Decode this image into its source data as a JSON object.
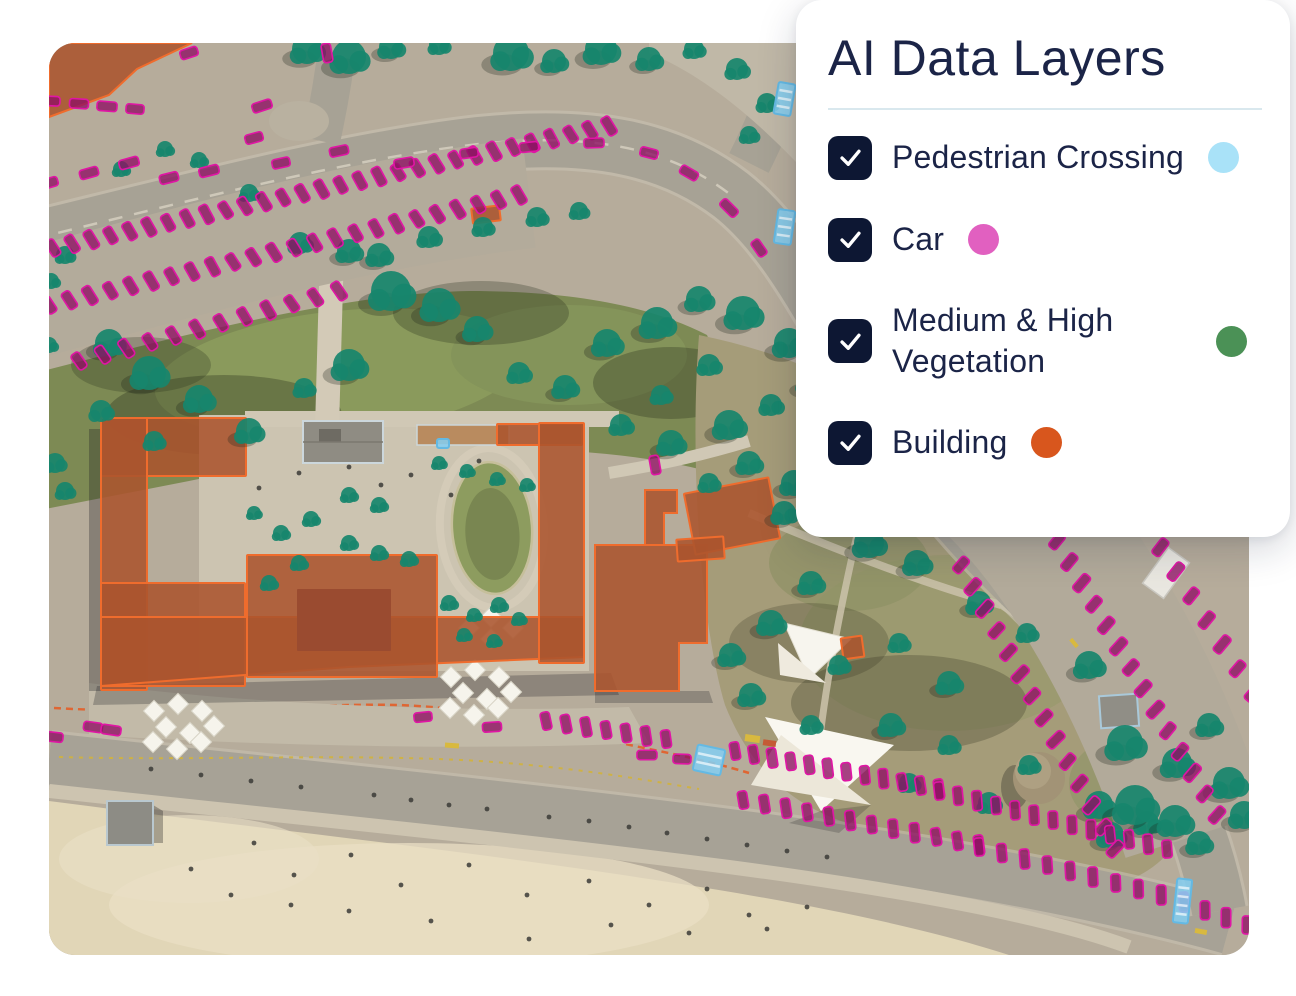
{
  "panel": {
    "title": "AI Data Layers",
    "layers": [
      {
        "id": "pedestrian-crossing",
        "label": "Pedestrian Crossing",
        "checked": true,
        "dot_color": "#a9e2f8"
      },
      {
        "id": "car",
        "label": "Car",
        "checked": true,
        "dot_color": "#e160c0"
      },
      {
        "id": "medium-high-vegetation",
        "label": "Medium & High Vegetation",
        "checked": true,
        "dot_color": "#4b9156"
      },
      {
        "id": "building",
        "label": "Building",
        "checked": true,
        "dot_color": "#d8561d"
      }
    ]
  },
  "map": {
    "overlay_colors": {
      "car_fill": "rgba(142,15,99,0.78)",
      "car_stroke": "#e015a5",
      "tree_fill": "rgba(23,134,108,0.92)",
      "tree_shadow": "rgba(30,36,24,0.28)",
      "building_fill": "rgba(171,84,46,0.88)",
      "building_stroke": "#ef6c2d",
      "crossing_fill": "rgba(133,205,239,0.88)",
      "crossing_stroke": "#64b9e3",
      "umbrella_fill": "#f6f4ec",
      "umbrella_stroke": "#d8d4c6",
      "people_fill": "#3b3b37"
    },
    "buildings": [
      {
        "d": "M0,0 L143,0 L88,26 L60,52 L0,74 Z"
      },
      {
        "x": 423,
        "y": 164,
        "w": 28,
        "h": 15,
        "rot": -7
      },
      {
        "x": 52,
        "y": 375,
        "w": 145,
        "h": 58
      },
      {
        "x": 52,
        "y": 375,
        "w": 46,
        "h": 272
      },
      {
        "x": 52,
        "y": 540,
        "w": 144,
        "h": 103
      },
      {
        "d": "M52,574 L535,574 L535,614 L300,624 L196,632 L52,643 Z"
      },
      {
        "x": 198,
        "y": 512,
        "w": 190,
        "h": 122
      },
      {
        "x": 248,
        "y": 546,
        "w": 94,
        "h": 62,
        "fill": "#9a4b30",
        "stroke": "none"
      },
      {
        "x": 448,
        "y": 381,
        "w": 85,
        "h": 21
      },
      {
        "x": 490,
        "y": 380,
        "w": 45,
        "h": 240
      },
      {
        "d": "M546,502 L658,502 L658,600 L630,600 L630,648 L546,648 Z"
      },
      {
        "x": 640,
        "y": 442,
        "w": 86,
        "h": 62,
        "rot": -11
      },
      {
        "d": "M596,447 L628,447 L628,470 L615,470 L615,502 L596,502 Z"
      },
      {
        "x": 628,
        "y": 495,
        "w": 47,
        "h": 22,
        "rot": -4
      },
      {
        "x": 793,
        "y": 594,
        "w": 21,
        "h": 21,
        "rot": -8
      }
    ],
    "trees": [
      [
        258,
        6,
        15
      ],
      [
        300,
        14,
        17
      ],
      [
        342,
        4,
        12
      ],
      [
        390,
        2,
        10
      ],
      [
        462,
        10,
        18
      ],
      [
        505,
        18,
        12
      ],
      [
        552,
        6,
        16
      ],
      [
        600,
        16,
        12
      ],
      [
        645,
        6,
        10
      ],
      [
        688,
        26,
        11
      ],
      [
        718,
        60,
        10
      ],
      [
        700,
        92,
        9
      ],
      [
        72,
        126,
        8
      ],
      [
        116,
        106,
        8
      ],
      [
        150,
        117,
        8
      ],
      [
        200,
        150,
        9
      ],
      [
        16,
        212,
        9
      ],
      [
        2,
        238,
        8
      ],
      [
        251,
        200,
        11
      ],
      [
        300,
        208,
        12
      ],
      [
        330,
        212,
        12
      ],
      [
        380,
        194,
        11
      ],
      [
        434,
        184,
        10
      ],
      [
        488,
        174,
        10
      ],
      [
        530,
        168,
        9
      ],
      [
        60,
        300,
        14
      ],
      [
        100,
        330,
        17
      ],
      [
        150,
        356,
        14
      ],
      [
        52,
        368,
        11
      ],
      [
        200,
        388,
        13
      ],
      [
        105,
        398,
        10
      ],
      [
        255,
        345,
        10
      ],
      [
        300,
        322,
        16
      ],
      [
        342,
        248,
        20
      ],
      [
        390,
        262,
        17
      ],
      [
        428,
        286,
        13
      ],
      [
        470,
        330,
        11
      ],
      [
        516,
        344,
        12
      ],
      [
        558,
        300,
        14
      ],
      [
        608,
        280,
        16
      ],
      [
        650,
        256,
        13
      ],
      [
        694,
        270,
        17
      ],
      [
        740,
        300,
        15
      ],
      [
        660,
        322,
        11
      ],
      [
        612,
        352,
        10
      ],
      [
        572,
        382,
        11
      ],
      [
        622,
        400,
        13
      ],
      [
        680,
        382,
        15
      ],
      [
        722,
        362,
        11
      ],
      [
        760,
        340,
        12
      ],
      [
        700,
        420,
        12
      ],
      [
        745,
        440,
        13
      ],
      [
        660,
        440,
        10
      ],
      [
        735,
        470,
        12
      ],
      [
        390,
        420,
        7
      ],
      [
        418,
        428,
        7
      ],
      [
        448,
        436,
        7
      ],
      [
        478,
        442,
        7
      ],
      [
        300,
        452,
        8
      ],
      [
        330,
        462,
        8
      ],
      [
        262,
        476,
        8
      ],
      [
        232,
        490,
        8
      ],
      [
        205,
        470,
        7
      ],
      [
        300,
        500,
        8
      ],
      [
        330,
        510,
        8
      ],
      [
        360,
        516,
        8
      ],
      [
        250,
        520,
        8
      ],
      [
        220,
        540,
        8
      ],
      [
        400,
        560,
        8
      ],
      [
        425,
        572,
        7
      ],
      [
        450,
        562,
        8
      ],
      [
        470,
        576,
        7
      ],
      [
        415,
        592,
        7
      ],
      [
        445,
        598,
        7
      ],
      [
        820,
        500,
        15
      ],
      [
        868,
        520,
        13
      ],
      [
        930,
        560,
        12
      ],
      [
        978,
        590,
        10
      ],
      [
        1040,
        622,
        14
      ],
      [
        900,
        640,
        12
      ],
      [
        850,
        600,
        10
      ],
      [
        762,
        540,
        12
      ],
      [
        722,
        580,
        13
      ],
      [
        682,
        612,
        12
      ],
      [
        790,
        622,
        10
      ],
      [
        842,
        682,
        12
      ],
      [
        900,
        702,
        10
      ],
      [
        1076,
        700,
        18
      ],
      [
        1128,
        720,
        15
      ],
      [
        1160,
        682,
        12
      ],
      [
        1050,
        762,
        14
      ],
      [
        1098,
        780,
        12
      ],
      [
        980,
        722,
        10
      ],
      [
        762,
        682,
        10
      ],
      [
        702,
        652,
        12
      ],
      [
        940,
        760,
        11
      ],
      [
        860,
        740,
        10
      ],
      [
        1086,
        762,
        20
      ],
      [
        1126,
        778,
        16
      ],
      [
        1062,
        792,
        13
      ],
      [
        1150,
        800,
        12
      ],
      [
        1180,
        740,
        16
      ],
      [
        1195,
        772,
        14
      ],
      [
        6,
        420,
        10
      ],
      [
        16,
        448,
        9
      ],
      [
        0,
        302,
        8
      ]
    ],
    "car_rows": [
      {
        "x1": 2,
        "y1": 58,
        "x2": 86,
        "y2": 66,
        "n": 4,
        "perp": false
      },
      {
        "x1": 0,
        "y1": 140,
        "x2": 80,
        "y2": 120,
        "n": 3,
        "perp": false
      },
      {
        "x1": 4,
        "y1": 205,
        "x2": 560,
        "y2": 83,
        "n": 30,
        "perp": true
      },
      {
        "x1": 0,
        "y1": 262,
        "x2": 470,
        "y2": 152,
        "n": 24,
        "perp": true
      },
      {
        "x1": 30,
        "y1": 318,
        "x2": 290,
        "y2": 248,
        "n": 12,
        "perp": true
      },
      {
        "x1": 912,
        "y1": 522,
        "x2": 1066,
        "y2": 806,
        "n": 14,
        "perp": true
      },
      {
        "x1": 1008,
        "y1": 498,
        "x2": 1168,
        "y2": 772,
        "n": 14,
        "perp": true
      },
      {
        "x1": 1096,
        "y1": 480,
        "x2": 1204,
        "y2": 650,
        "n": 8,
        "perp": true
      },
      {
        "x1": 497,
        "y1": 678,
        "x2": 617,
        "y2": 696,
        "n": 7,
        "perp": true
      },
      {
        "x1": 686,
        "y1": 708,
        "x2": 890,
        "y2": 746,
        "n": 12,
        "perp": true
      },
      {
        "x1": 890,
        "y1": 748,
        "x2": 1118,
        "y2": 806,
        "n": 13,
        "perp": true
      },
      {
        "x1": 694,
        "y1": 757,
        "x2": 930,
        "y2": 802,
        "n": 12,
        "perp": true
      },
      {
        "x1": 930,
        "y1": 804,
        "x2": 1135,
        "y2": 858,
        "n": 10,
        "perp": true
      },
      {
        "x1": 1135,
        "y1": 860,
        "x2": 1198,
        "y2": 882,
        "n": 4,
        "perp": true
      }
    ],
    "cars": [
      [
        140,
        10,
        -18
      ],
      [
        278,
        10,
        80
      ],
      [
        213,
        63,
        -18
      ],
      [
        205,
        95,
        -15
      ],
      [
        120,
        135,
        -14
      ],
      [
        160,
        128,
        -14
      ],
      [
        232,
        120,
        -12
      ],
      [
        290,
        108,
        -12
      ],
      [
        355,
        120,
        -10
      ],
      [
        420,
        110,
        -8
      ],
      [
        480,
        104,
        -6
      ],
      [
        545,
        100,
        -2
      ],
      [
        600,
        110,
        14
      ],
      [
        640,
        130,
        30
      ],
      [
        680,
        165,
        45
      ],
      [
        710,
        205,
        55
      ],
      [
        606,
        422,
        80
      ],
      [
        1146,
        466,
        60
      ],
      [
        374,
        674,
        -6
      ],
      [
        443,
        684,
        -4
      ],
      [
        598,
        712,
        0
      ],
      [
        633,
        716,
        2
      ],
      [
        44,
        684,
        8
      ],
      [
        62,
        687,
        8
      ],
      [
        5,
        694,
        6
      ]
    ],
    "crossings": [
      {
        "x": 727,
        "y": 40,
        "w": 17,
        "h": 32,
        "rot": 10
      },
      {
        "x": 727,
        "y": 167,
        "w": 17,
        "h": 34,
        "rot": 8
      },
      {
        "x": 646,
        "y": 704,
        "w": 28,
        "h": 26,
        "rot": 12
      },
      {
        "x": 1126,
        "y": 836,
        "w": 15,
        "h": 44,
        "rot": 6
      },
      {
        "x": 388,
        "y": 396,
        "w": 12,
        "h": 9,
        "rot": 0
      }
    ],
    "umbrellas": {
      "size": 15,
      "positions": [
        [
          105,
          668
        ],
        [
          129,
          661
        ],
        [
          153,
          668
        ],
        [
          117,
          684
        ],
        [
          141,
          690
        ],
        [
          165,
          683
        ],
        [
          104,
          699
        ],
        [
          128,
          706
        ],
        [
          152,
          699
        ],
        [
          402,
          634
        ],
        [
          426,
          627
        ],
        [
          450,
          634
        ],
        [
          414,
          650
        ],
        [
          438,
          656
        ],
        [
          462,
          649
        ],
        [
          401,
          665
        ],
        [
          425,
          672
        ],
        [
          449,
          665
        ],
        [
          420,
          585
        ],
        [
          442,
          596
        ],
        [
          464,
          585
        ],
        [
          442,
          574
        ]
      ]
    },
    "people": [
      [
        205,
        800
      ],
      [
        245,
        832
      ],
      [
        302,
        812
      ],
      [
        352,
        842
      ],
      [
        420,
        822
      ],
      [
        478,
        852
      ],
      [
        540,
        838
      ],
      [
        600,
        862
      ],
      [
        658,
        846
      ],
      [
        700,
        872
      ],
      [
        758,
        864
      ],
      [
        562,
        882
      ],
      [
        480,
        896
      ],
      [
        382,
        878
      ],
      [
        300,
        868
      ],
      [
        242,
        862
      ],
      [
        182,
        852
      ],
      [
        142,
        826
      ],
      [
        640,
        890
      ],
      [
        718,
        886
      ],
      [
        325,
        752
      ],
      [
        362,
        757
      ],
      [
        400,
        762
      ],
      [
        438,
        766
      ],
      [
        500,
        774
      ],
      [
        540,
        778
      ],
      [
        580,
        784
      ],
      [
        618,
        790
      ],
      [
        658,
        796
      ],
      [
        698,
        802
      ],
      [
        252,
        744
      ],
      [
        202,
        738
      ],
      [
        152,
        732
      ],
      [
        102,
        726
      ],
      [
        738,
        808
      ],
      [
        778,
        814
      ],
      [
        300,
        424
      ],
      [
        332,
        442
      ],
      [
        362,
        432
      ],
      [
        402,
        452
      ],
      [
        430,
        418
      ],
      [
        250,
        430
      ],
      [
        210,
        445
      ]
    ]
  }
}
